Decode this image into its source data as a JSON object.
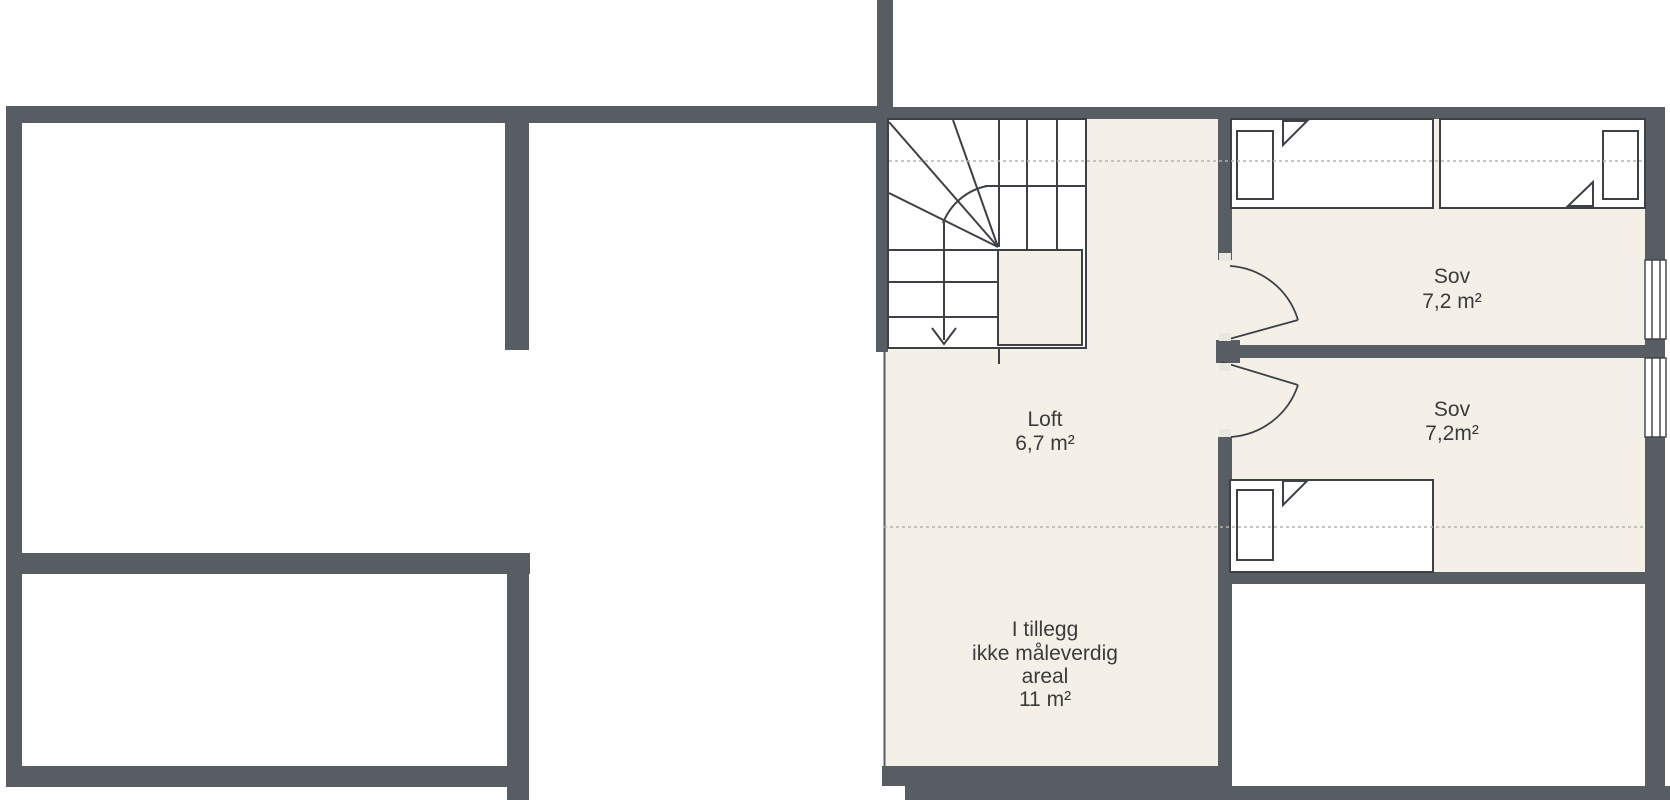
{
  "floorplan": {
    "rooms": {
      "bedroom1": {
        "name": "Sov",
        "area": "7,2 m²"
      },
      "bedroom2": {
        "name": "Sov",
        "area": "7,2m²"
      },
      "loft": {
        "name": "Loft",
        "area": "6,7 m²"
      }
    },
    "annotation": {
      "line1": "I tillegg",
      "line2": "ikke måleverdig",
      "line3": "areal",
      "line4": "11 m²"
    },
    "colors": {
      "wall": "#585d64",
      "room_fill": "#f4f0e7",
      "outline": "#3d4145",
      "dashed": "#b4b4ac",
      "text": "#3b3b3b",
      "frame_cap": "#e9e7df"
    }
  }
}
